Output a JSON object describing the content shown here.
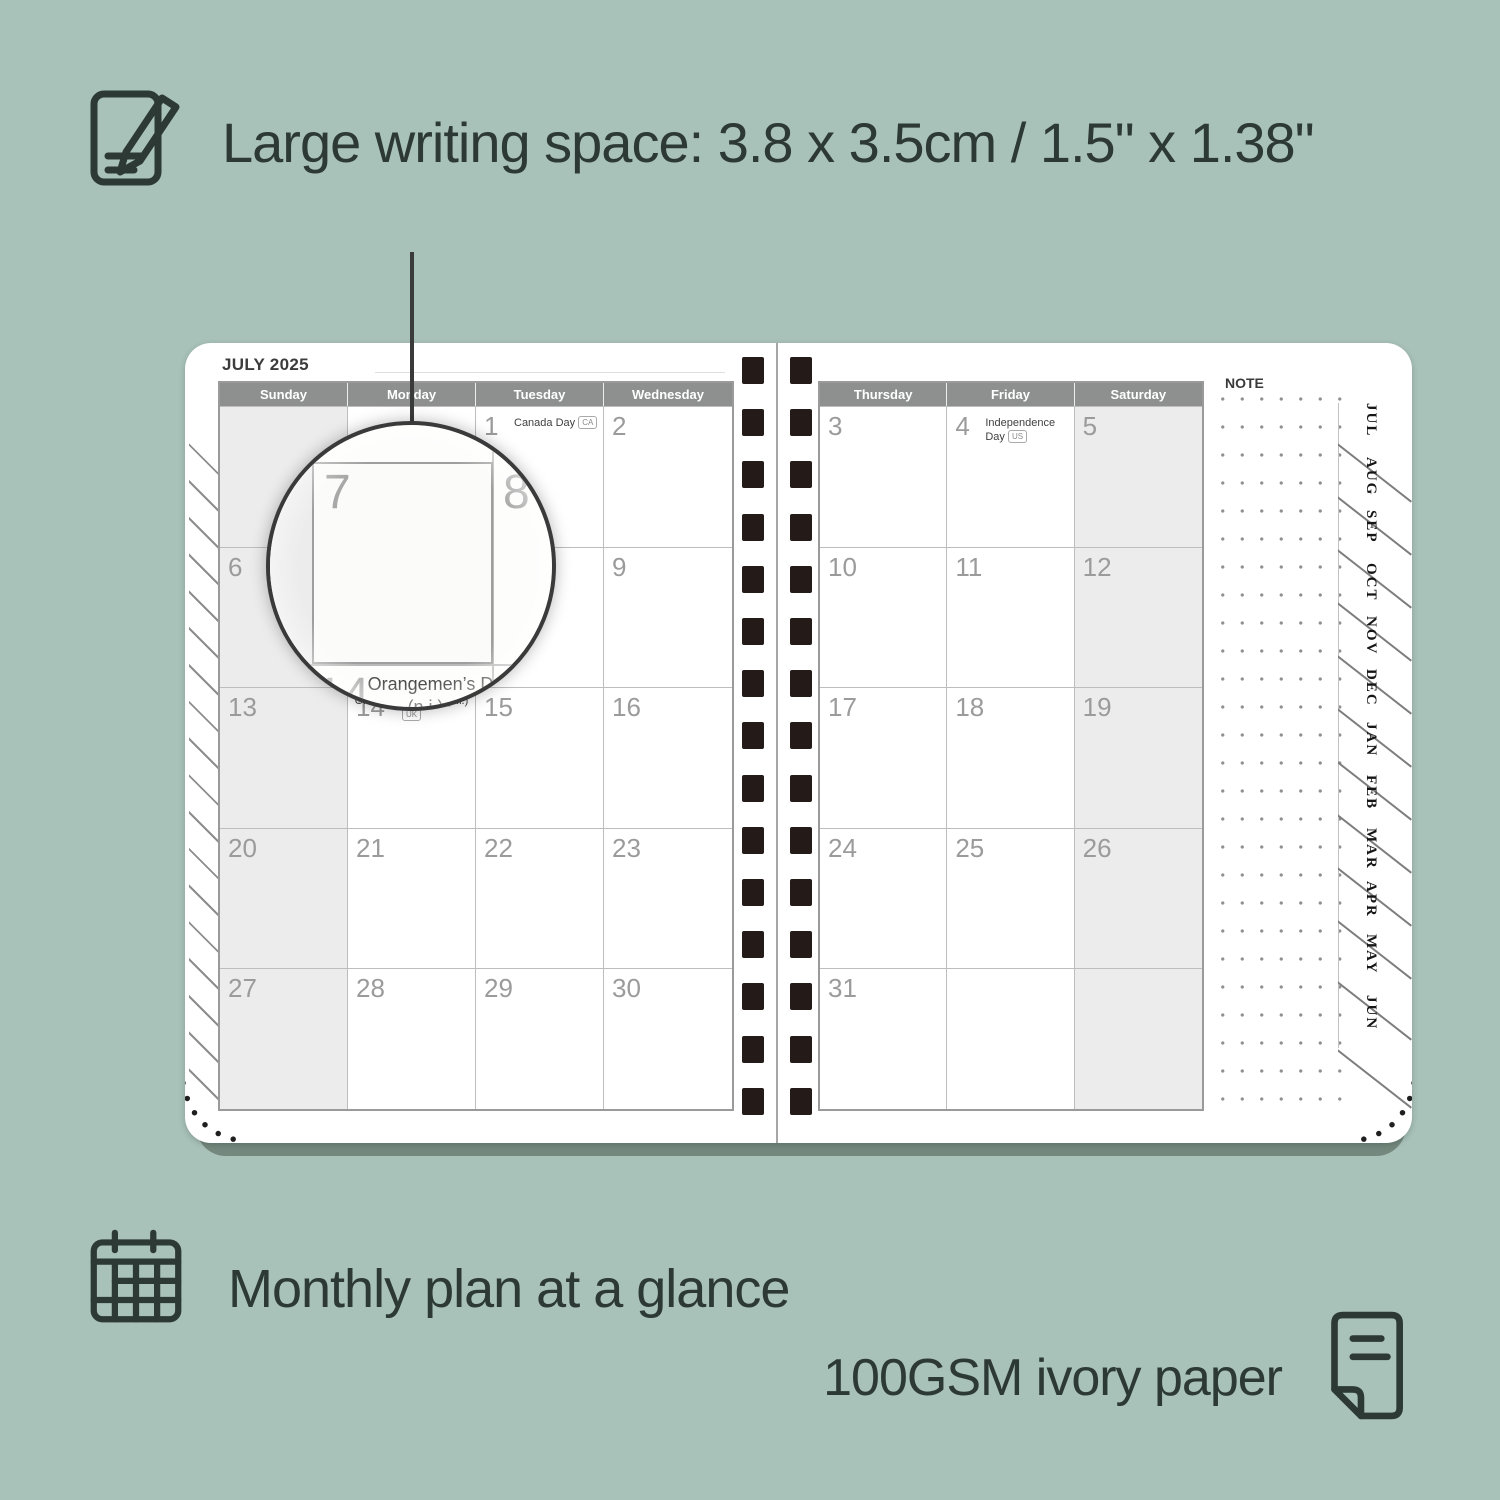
{
  "headlines": {
    "writing_space": "Large writing space: 3.8 x 3.5cm / 1.5\" x 1.38\"",
    "monthly_plan": "Monthly plan at a glance",
    "paper": "100GSM ivory paper"
  },
  "planner": {
    "title": "JULY 2025",
    "note_label": "NOTE",
    "tabs": [
      "JUL",
      "AUG",
      "SEP",
      "OCT",
      "NOV",
      "DEC",
      "JAN",
      "FEB",
      "MAR",
      "APR",
      "MAY",
      "JUN"
    ],
    "left_page": {
      "day_headers": [
        "Sunday",
        "Monday",
        "Tuesday",
        "Wednesday"
      ],
      "weeks": [
        [
          {
            "day": "",
            "shaded": true
          },
          {
            "day": ""
          },
          {
            "day": "1",
            "holiday": "Canada Day",
            "badge": "CA"
          },
          {
            "day": "2"
          }
        ],
        [
          {
            "day": "6",
            "shaded": true
          },
          {
            "day": "7"
          },
          {
            "day": "8"
          },
          {
            "day": "9"
          }
        ],
        [
          {
            "day": "13",
            "shaded": true
          },
          {
            "day": "14",
            "holiday": "Orangemen’s Day (n.i.)",
            "badge": "UK",
            "center": true
          },
          {
            "day": "15"
          },
          {
            "day": "16"
          }
        ],
        [
          {
            "day": "20",
            "shaded": true
          },
          {
            "day": "21"
          },
          {
            "day": "22"
          },
          {
            "day": "23"
          }
        ],
        [
          {
            "day": "27",
            "shaded": true
          },
          {
            "day": "28"
          },
          {
            "day": "29"
          },
          {
            "day": "30"
          }
        ]
      ]
    },
    "right_page": {
      "day_headers": [
        "Thursday",
        "Friday",
        "Saturday"
      ],
      "weeks": [
        [
          {
            "day": "3"
          },
          {
            "day": "4",
            "holiday": "Independence Day",
            "badge": "US"
          },
          {
            "day": "5",
            "shaded": true
          }
        ],
        [
          {
            "day": "10"
          },
          {
            "day": "11"
          },
          {
            "day": "12",
            "shaded": true
          }
        ],
        [
          {
            "day": "17"
          },
          {
            "day": "18"
          },
          {
            "day": "19",
            "shaded": true
          }
        ],
        [
          {
            "day": "24"
          },
          {
            "day": "25"
          },
          {
            "day": "26",
            "shaded": true
          }
        ],
        [
          {
            "day": "31"
          },
          {
            "day": ""
          },
          {
            "day": "",
            "shaded": true
          }
        ]
      ]
    },
    "magnifier": {
      "day_top_left": "7",
      "day_top_right": "8",
      "day_bottom": "14",
      "holiday_line1": "Orangemen’s Day",
      "holiday_line2": "(n.i.)",
      "badge": "UK"
    },
    "binding_holes_per_column": 15
  },
  "colors": {
    "background": "#a8c1b9",
    "headline_text": "#2d3934",
    "header_bar": "#8e9090",
    "shaded_cell": "#ececec",
    "day_number": "#9b9b9b",
    "binding_hole": "#241b18",
    "page": "#ffffff",
    "shadow_bar": "#75887e"
  }
}
